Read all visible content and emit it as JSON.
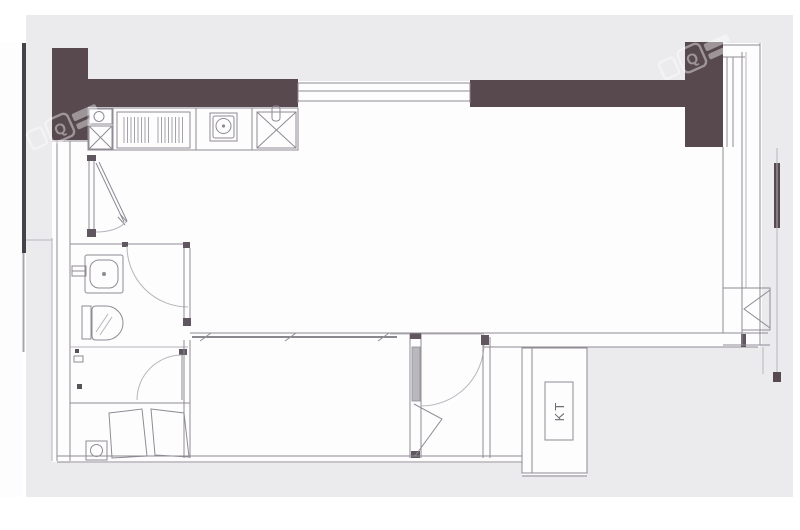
{
  "canvas": {
    "background": "#ffffff",
    "panel_color": "#ebebee",
    "paper_color": "#fdfdfe"
  },
  "floorplan": {
    "wall_color": "#57494e",
    "line_color": "#8f8b94",
    "labels": {
      "duct": "KT"
    },
    "watermark": {
      "letter": "Q"
    },
    "fixtures": {
      "kitchen": [
        "corner-sink",
        "corner-cabinet",
        "dish-rack",
        "cooktop",
        "prep-sink"
      ],
      "bathroom": [
        "washbasin",
        "faucet",
        "toilet",
        "shower-valve"
      ],
      "laundry": [
        "washing-machine",
        "wardrobe-doors"
      ],
      "doors": [
        "entry-door",
        "bathroom-door",
        "shower-door",
        "bedroom-door",
        "sliding-panel"
      ],
      "windows": [
        "top-window",
        "floor-to-ceiling-window",
        "corner-window"
      ]
    }
  }
}
